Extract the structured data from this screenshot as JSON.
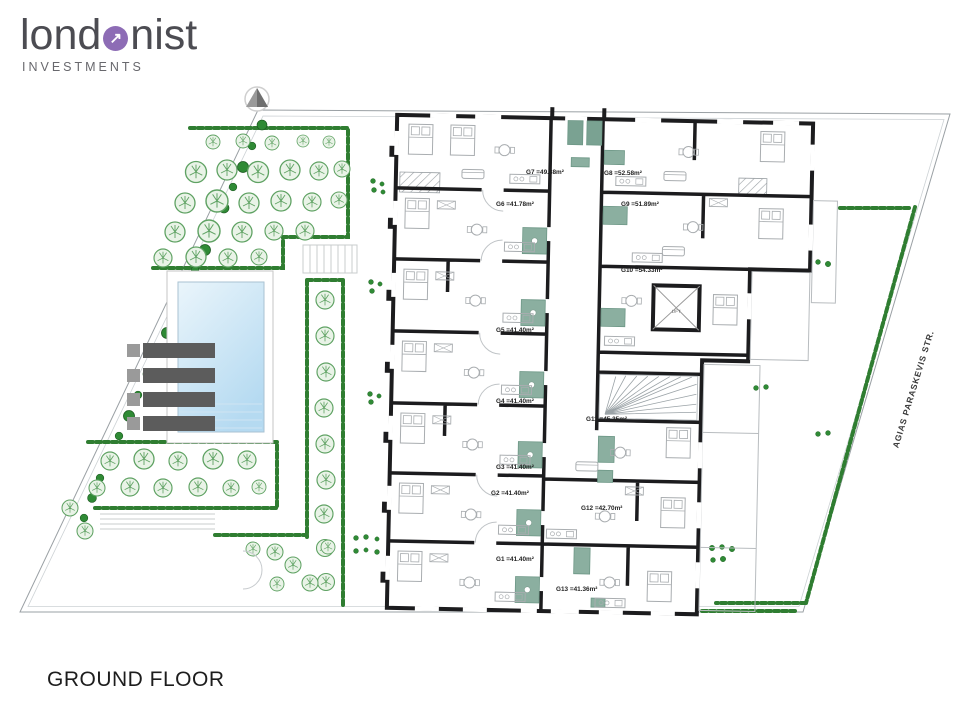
{
  "brand": {
    "logo_left": "lond",
    "logo_right": "nist",
    "logo_arrow": "↗",
    "subtitle": "INVESTMENTS"
  },
  "plan": {
    "title": "GROUND FLOOR",
    "street_label": "AGIAS PARASKEVIS STR.",
    "lift_label": "LIFT",
    "apartments": [
      {
        "id": "G1",
        "label": "G1 =41.40m²"
      },
      {
        "id": "G2",
        "label": "G2 =41.40m²"
      },
      {
        "id": "G3",
        "label": "G3 =41.40m²"
      },
      {
        "id": "G4",
        "label": "G4 =41.40m²"
      },
      {
        "id": "G5",
        "label": "G5 =41.40m²"
      },
      {
        "id": "G6",
        "label": "G6 =41.78m²"
      },
      {
        "id": "G7",
        "label": "G7 =49.88m²"
      },
      {
        "id": "G8",
        "label": "G8 =52.58m²"
      },
      {
        "id": "G9",
        "label": "G9 =51.89m²"
      },
      {
        "id": "G10",
        "label": "G10 =54.33m²"
      },
      {
        "id": "G11",
        "label": "G11 =45.35m²"
      },
      {
        "id": "G12",
        "label": "G12 =42.70m²"
      },
      {
        "id": "G13",
        "label": "G13 =41.36m²"
      }
    ]
  },
  "icons": {
    "north_arrow": "triangle-up",
    "lift": "x-cross-square"
  },
  "colors": {
    "brand_purple": "#8d6cb5",
    "walls": "#1c1c1e",
    "bathroom_teal": "#8bafa0",
    "hedge_green": "#2f7d31",
    "pool_blue": "#b5daf1"
  }
}
